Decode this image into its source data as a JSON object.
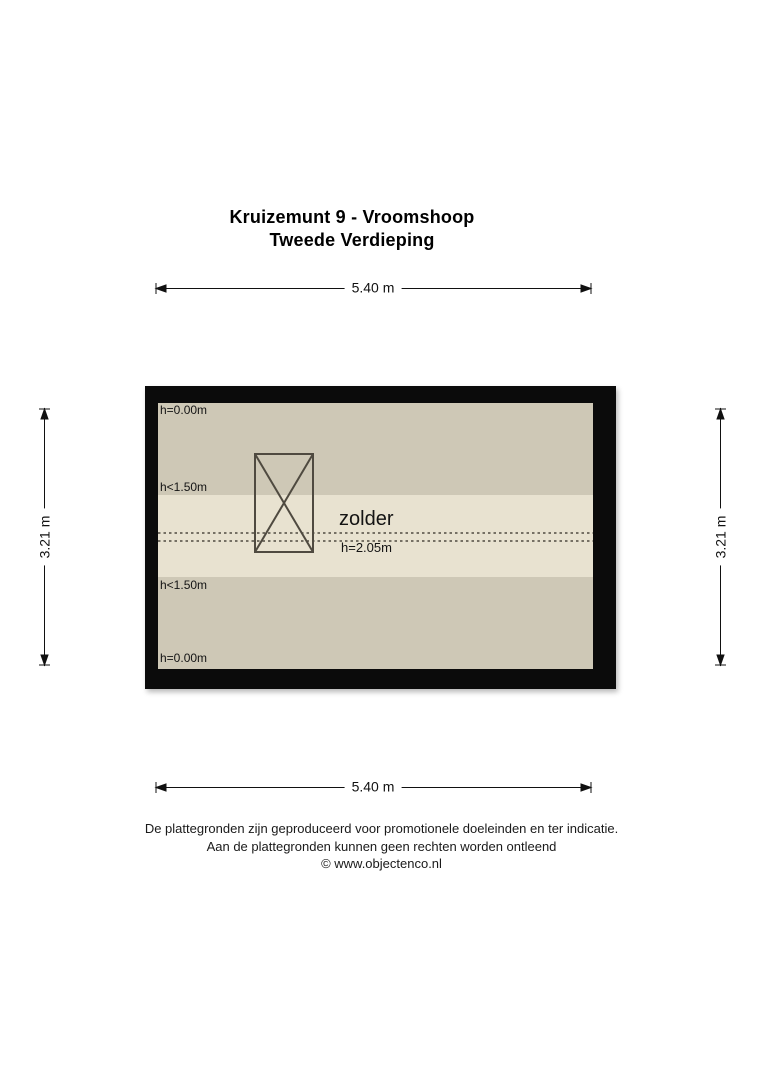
{
  "title": {
    "line1": "Kruizemunt 9 - Vroomshoop",
    "line2": "Tweede Verdieping"
  },
  "dimensions": {
    "top": "5.40 m",
    "bottom": "5.40 m",
    "left": "3.21 m",
    "right": "3.21 m"
  },
  "floorplan": {
    "room_label": "zolder",
    "height_labels": {
      "top": "h=0.00m",
      "upper": "h<1.50m",
      "center": "h=2.05m",
      "lower": "h<1.50m",
      "bottom": "h=0.00m"
    }
  },
  "footer": {
    "line1": "De plattegronden zijn geproduceerd voor promotionele doeleinden en ter indicatie.",
    "line2": "Aan de plattegronden kunnen geen rechten worden ontleend",
    "line3": "© www.objectenco.nl"
  },
  "colors": {
    "wall": "#0b0b0b",
    "band_dark": "#cec8b6",
    "band_light": "#e8e2d0",
    "linework": "#4f4a40",
    "dimension": "#111111"
  }
}
